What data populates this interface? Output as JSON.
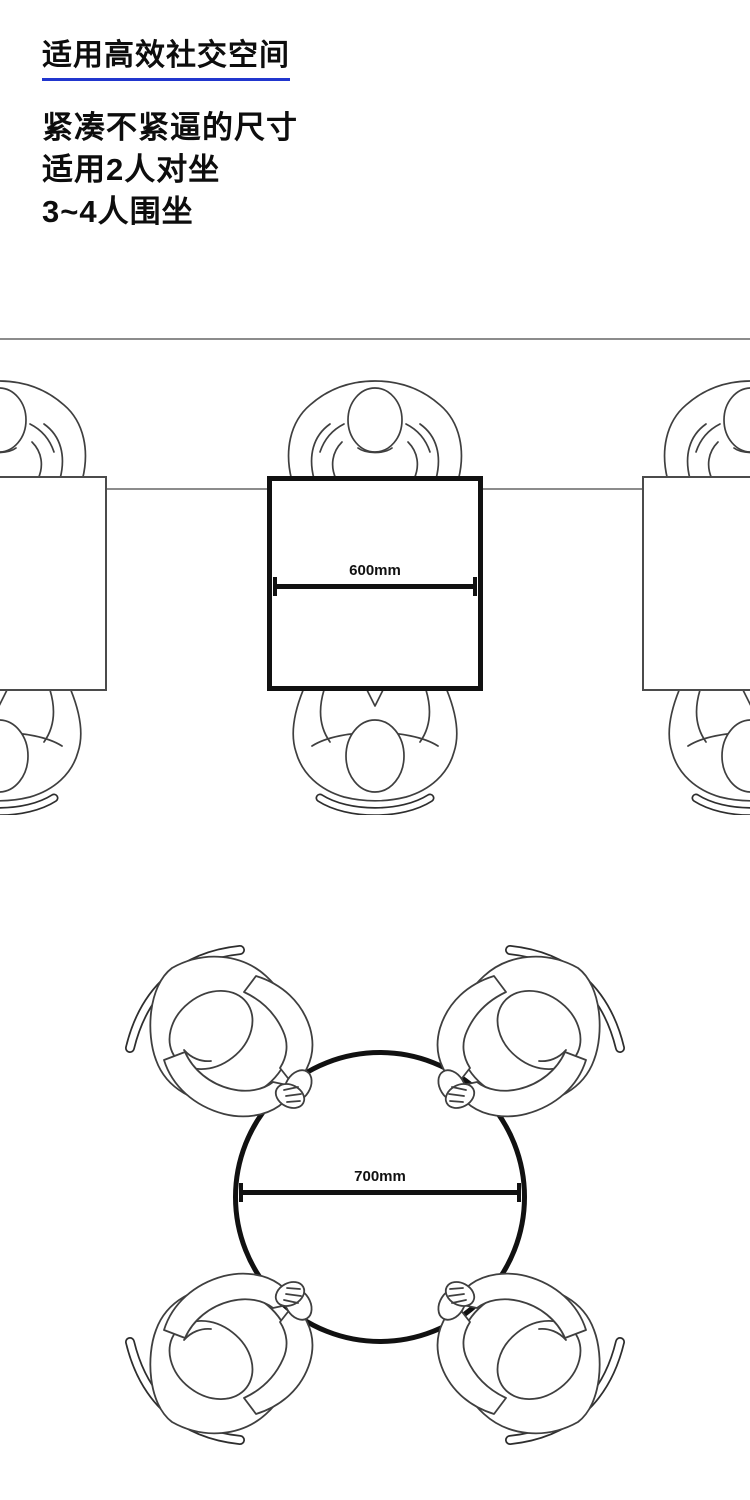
{
  "page": {
    "width": 750,
    "height": 1500,
    "background": "#ffffff"
  },
  "header": {
    "title": "适用高效社交空间",
    "underline_color": "#2136ce",
    "description_lines": [
      "紧凑不紧逼的尺寸",
      "适用2人对坐",
      "3~4人围坐"
    ]
  },
  "square_table_diagram": {
    "dimension_label": "600mm",
    "table_shape": "square",
    "seated_people": 2,
    "neighboring_partial_tables": 2
  },
  "round_table_diagram": {
    "dimension_label": "700mm",
    "table_shape": "round",
    "seated_people": 4
  },
  "colors": {
    "table_border": "#111111",
    "side_table_border": "#4b4b4b",
    "guide_line": "#8c8c8c",
    "figure_outline": "#3f3f3f",
    "dimension_marker": "#111111",
    "title_underline": "#2136ce",
    "text": "#0d0d0d"
  }
}
